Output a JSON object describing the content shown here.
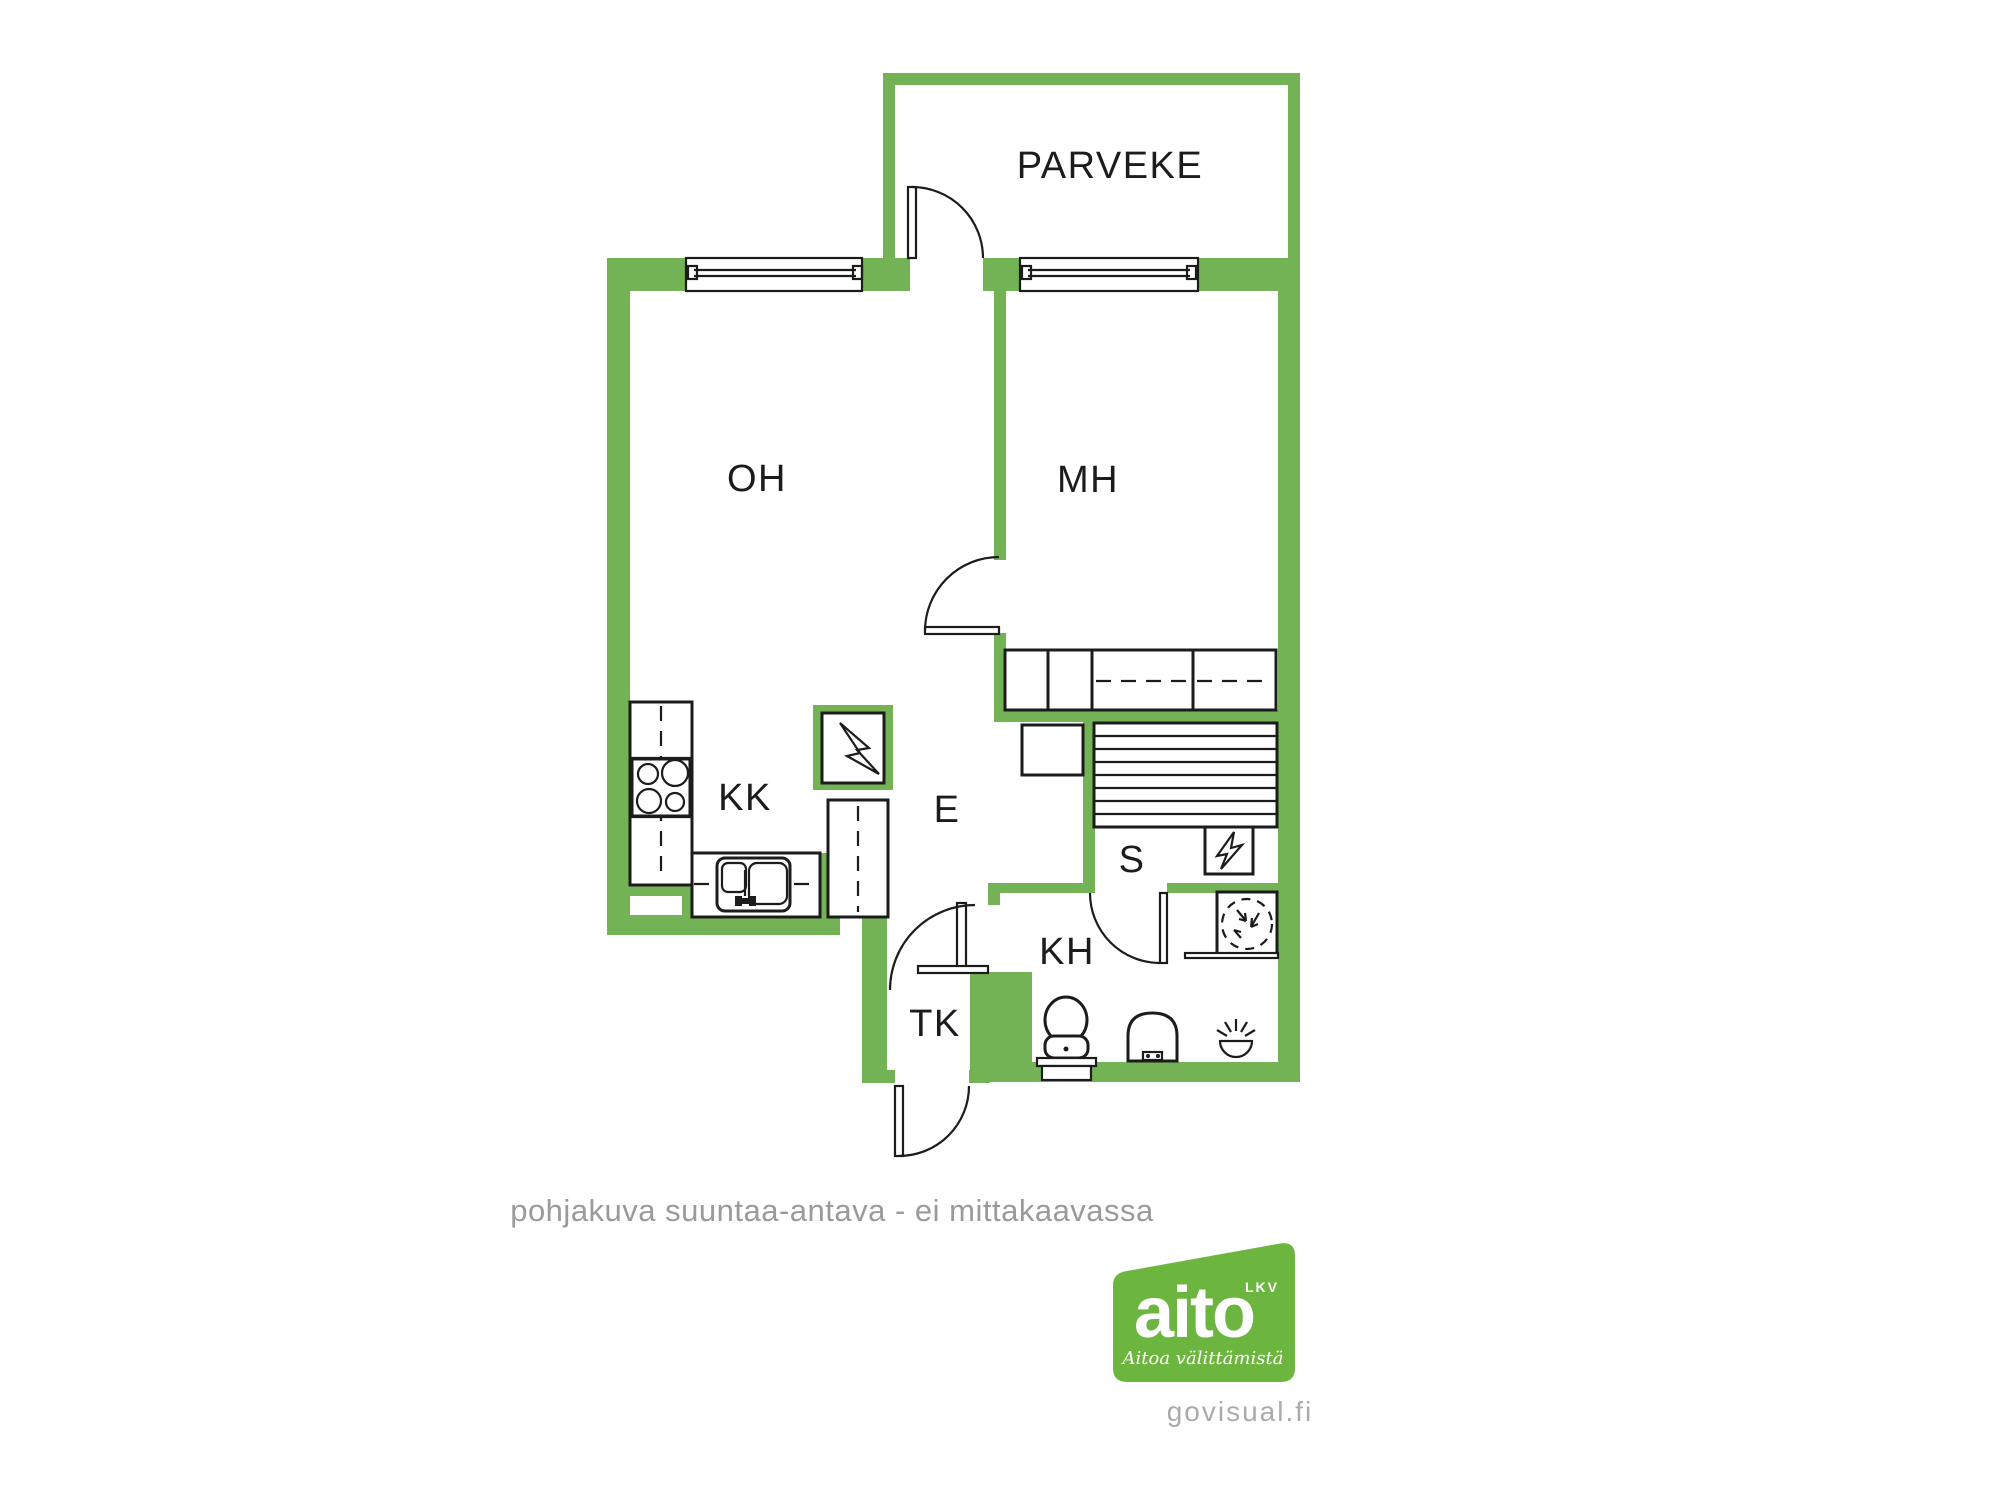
{
  "meta": {
    "type": "apartment-floor-plan"
  },
  "colors": {
    "wall": "#73B355",
    "logo": "#6CB63F",
    "line": "#1C1C1C",
    "caption": "#9A9A9A",
    "watermark": "#ABABAB"
  },
  "rooms": {
    "parveke": "PARVEKE",
    "oh": "OH",
    "mh": "MH",
    "kk": "KK",
    "e": "E",
    "s": "S",
    "kh": "KH",
    "tk": "TK"
  },
  "caption": "pohjakuva suuntaa-antava - ei mittakaavassa",
  "logo": {
    "brand": "aito",
    "suffix": "LKV",
    "tagline": "Aitoa välittämistä",
    "watermark": "govisual.fi"
  },
  "icons": {
    "stove": "stove-icon",
    "sink": "kitchen-sink-icon",
    "fridge_cabinets": "kitchen-cabinet-run",
    "electrical_panel": "electrical-panel-icon",
    "sauna_heater": "sauna-heater-icon",
    "sauna_benches": "sauna-benches",
    "washing_machine": "washing-machine-icon",
    "toilet": "toilet-icon",
    "washbasin": "washbasin-icon",
    "floor_drain": "floor-drain-icon",
    "wardrobes": "wardrobe-row",
    "doors": "door-swing-symbols",
    "windows": "window-symbols"
  }
}
